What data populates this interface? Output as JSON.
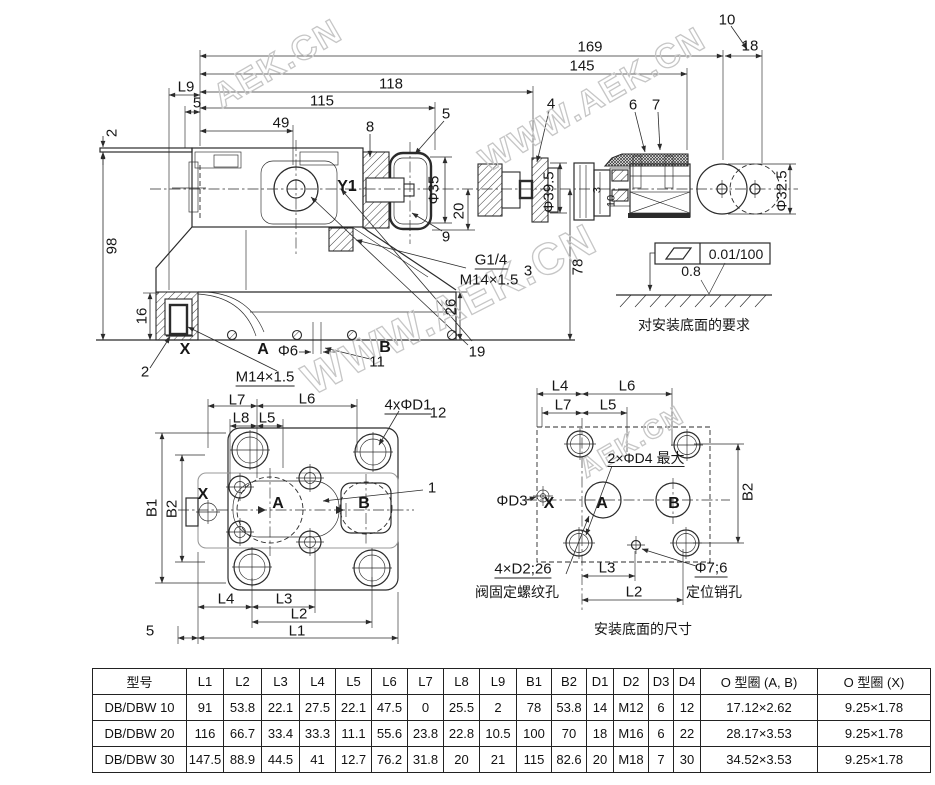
{
  "watermark": {
    "short": "AEK.CN",
    "long": "WWW.AEK.CN"
  },
  "main_view": {
    "dims": {
      "d169": "169",
      "d145": "145",
      "d118": "118",
      "d115": "115",
      "d49": "49",
      "dL9": "L9",
      "d5_left": "5",
      "d2_plate": "2",
      "d98": "98",
      "d16": "16",
      "d10_item": "10",
      "d18": "18",
      "d8_item": "8",
      "d5_cap": "5",
      "d4_item": "4",
      "d6_item": "6",
      "d7_item": "7",
      "phi35": "Φ35",
      "d20": "20",
      "d9_item": "9",
      "phi39_5": "Φ39.5",
      "d78": "78",
      "d26": "26",
      "d19_item": "19",
      "d3_sol": "3",
      "d10_sol": "10",
      "phi32_5": "Φ32.5",
      "d2_x": "2",
      "phi6": "Φ6",
      "d11_item": "11",
      "d3_note": "3"
    },
    "ports": {
      "y1": "Y1",
      "x": "X",
      "a": "A",
      "b": "B"
    },
    "notes": {
      "g_thread": "G1/4",
      "m_thread": "M14×1.5",
      "x_thread": "M14×1.5"
    }
  },
  "flatness": {
    "tolerance": "0.01/100",
    "roughness": "0.8",
    "caption": "对安装底面的要求"
  },
  "bottom_view": {
    "dims": {
      "L1": "L1",
      "L2": "L2",
      "L3": "L3",
      "L4": "L4",
      "L5": "L5",
      "L6": "L6",
      "L7": "L7",
      "L8": "L8",
      "B1": "B1",
      "B2": "B2",
      "d5": "5",
      "holes": "4xΦD1",
      "d12_item": "12",
      "d1_item": "1"
    },
    "ports": {
      "x": "X",
      "a": "A",
      "b": "B"
    }
  },
  "mounting_view": {
    "dims": {
      "L2": "L2",
      "L3": "L3",
      "L4": "L4",
      "L5": "L5",
      "L6": "L6",
      "L7": "L7",
      "B2": "B2"
    },
    "labels": {
      "d4_max": "2×ΦD4 最大",
      "d3": "ΦD3",
      "screws": "4×D2;26",
      "screws_note": "阀固定螺纹孔",
      "pin": "Φ7;6",
      "pin_note": "定位销孔"
    },
    "ports": {
      "x": "X",
      "a": "A",
      "b": "B"
    },
    "caption": "安装底面的尺寸"
  },
  "table": {
    "headers": [
      "型号",
      "L1",
      "L2",
      "L3",
      "L4",
      "L5",
      "L6",
      "L7",
      "L8",
      "L9",
      "B1",
      "B2",
      "D1",
      "D2",
      "D3",
      "D4",
      "O 型圈 (A, B)",
      "O 型圈 (X)"
    ],
    "rows": [
      [
        "DB/DBW 10",
        "91",
        "53.8",
        "22.1",
        "27.5",
        "22.1",
        "47.5",
        "0",
        "25.5",
        "2",
        "78",
        "53.8",
        "14",
        "M12",
        "6",
        "12",
        "17.12×2.62",
        "9.25×1.78"
      ],
      [
        "DB/DBW 20",
        "116",
        "66.7",
        "33.4",
        "33.3",
        "11.1",
        "55.6",
        "23.8",
        "22.8",
        "10.5",
        "100",
        "70",
        "18",
        "M16",
        "6",
        "22",
        "28.17×3.53",
        "9.25×1.78"
      ],
      [
        "DB/DBW 30",
        "147.5",
        "88.9",
        "44.5",
        "41",
        "12.7",
        "76.2",
        "31.8",
        "20",
        "21",
        "115",
        "82.6",
        "20",
        "M18",
        "7",
        "30",
        "34.52×3.53",
        "9.25×1.78"
      ]
    ]
  }
}
